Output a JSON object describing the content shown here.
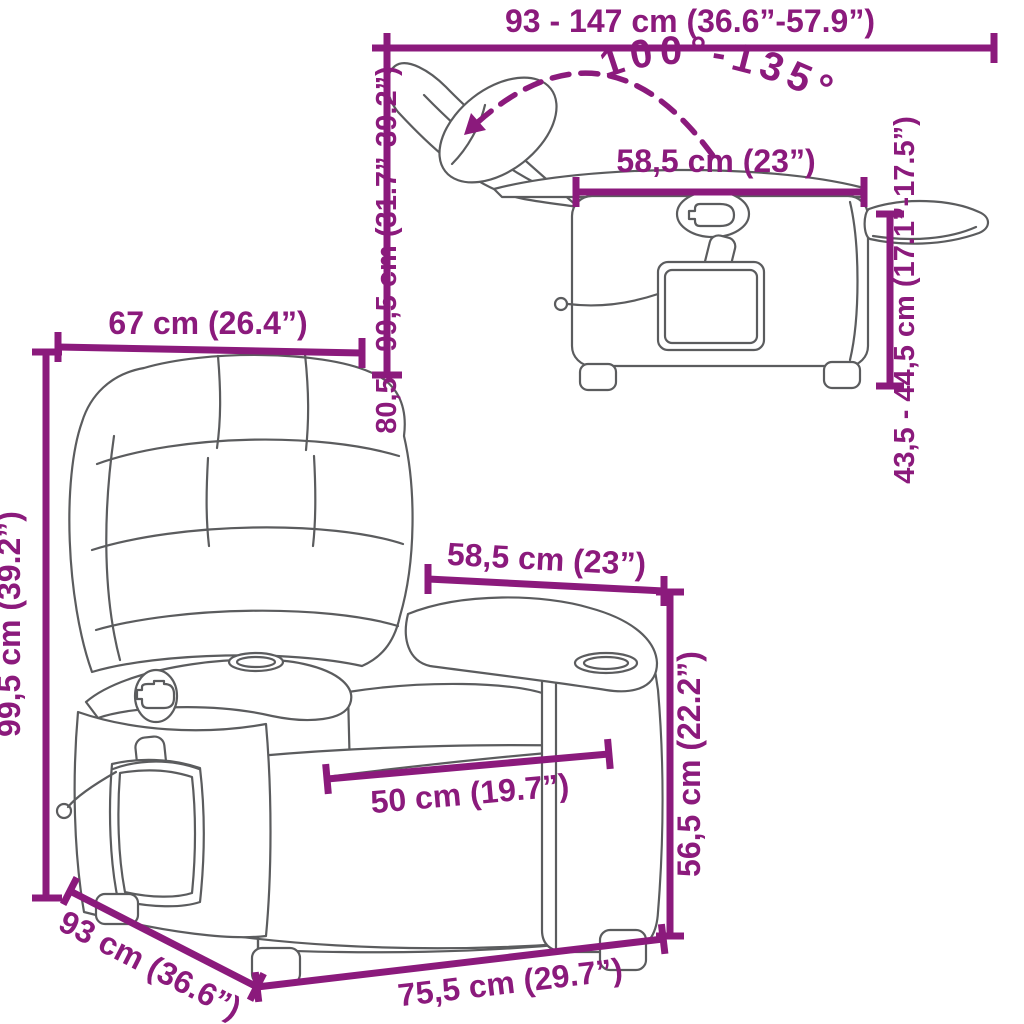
{
  "page": {
    "kind": "product-dimension-diagram",
    "product": "massage recliner chair",
    "background": "#ffffff",
    "accent_color": "#8B1A7C",
    "drawing_line_color": "#5b5c5e"
  },
  "reclined_view": {
    "length_range": "93 - 147 cm (36.6”-57.9”)",
    "recline_angle": "100°-135°",
    "armrest_length": "58,5 cm (23”)",
    "height_range": "80,5 - 99,5 cm (31.7”-39.2”)",
    "seat_height_range": "43,5 - 44,5 cm (17.1”-17.5”)"
  },
  "front_view": {
    "backrest_width": "67 cm (26.4”)",
    "total_height": "99,5 cm (39.2”)",
    "armrest_length": "58,5 cm (23”)",
    "seat_width": "50 cm (19.7”)",
    "armrest_height": "56,5 cm (22.2”)",
    "depth": "93 cm (36.6”)",
    "front_width": "75,5 cm (29.7”)"
  }
}
